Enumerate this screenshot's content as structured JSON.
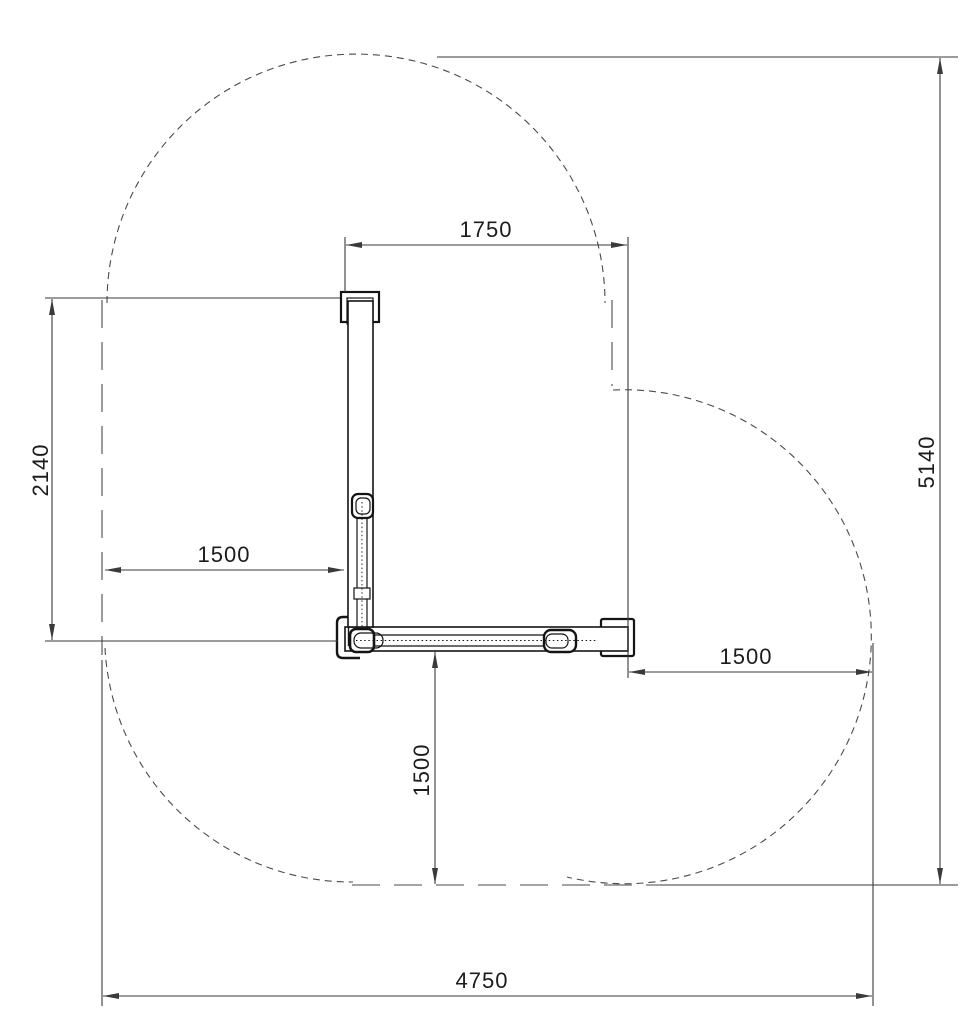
{
  "dimensions": {
    "top_width": "1750",
    "left_height": "2140",
    "left_clearance": "1500",
    "right_clearance": "1500",
    "bottom_clearance": "1500",
    "overall_height": "5140",
    "overall_width": "4750"
  },
  "colors": {
    "background": "#ffffff",
    "equipment_line": "#141414",
    "dimension_line": "#3a3a3a",
    "boundary_line": "#4a4a4a",
    "text": "#1c1c1c"
  }
}
